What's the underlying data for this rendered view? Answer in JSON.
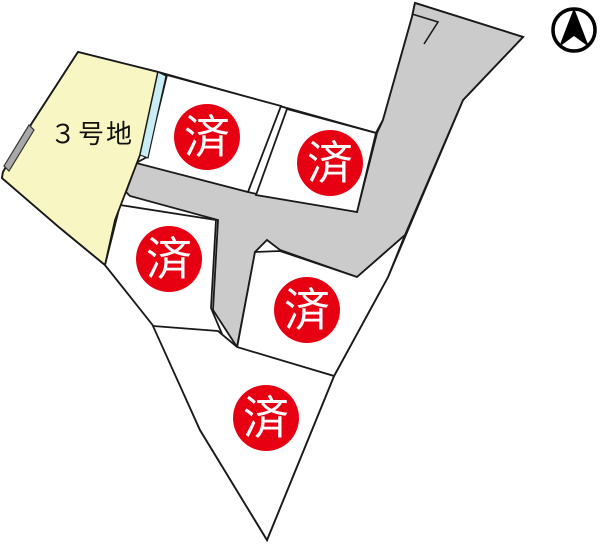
{
  "map": {
    "title": "lot-map",
    "lot3_label": "３号地",
    "sold_markers": [
      {
        "label": "済"
      },
      {
        "label": "済"
      },
      {
        "label": "済"
      },
      {
        "label": "済"
      },
      {
        "label": "済"
      }
    ]
  },
  "icons": {
    "compass": "north-arrow-icon"
  },
  "colors": {
    "lot_yellow": "#f8f7c3",
    "road_gray": "#cbcbcb",
    "water_strip_cyan": "#c9edf4",
    "sold_red": "#e60012",
    "outline_black": "#1a1a1a",
    "wall_gray": "#a8a8a8"
  }
}
